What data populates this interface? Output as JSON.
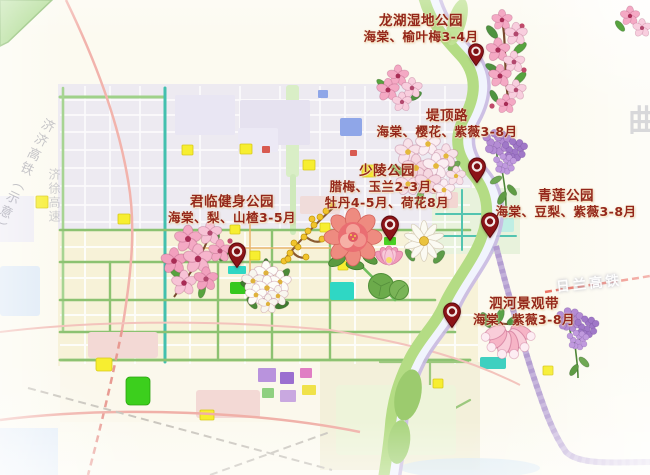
{
  "watermarks": {
    "railway_planned": "济济高铁（示意）",
    "expressway": "济徐高速",
    "railway_hsr": "日兰高铁",
    "partial_char": "曲"
  },
  "locations": [
    {
      "id": "longhu",
      "name": "龙湖湿地公园",
      "lines": [
        "海棠、榆叶梅3-4月"
      ]
    },
    {
      "id": "didinglu",
      "name": "堤顶路",
      "lines": [
        "海棠、樱花、紫薇3-8月"
      ]
    },
    {
      "id": "shaoling",
      "name": "少陵公园",
      "lines": [
        "腊梅、玉兰2-3月、",
        "牡丹4-5月、荷花8月"
      ]
    },
    {
      "id": "qinglian",
      "name": "青莲公园",
      "lines": [
        "海棠、豆梨、紫薇3-8月"
      ]
    },
    {
      "id": "junlin",
      "name": "君临健身公园",
      "lines": [
        "海棠、梨、山楂3-5月"
      ]
    },
    {
      "id": "sihe",
      "name": "泗河景观带",
      "lines": [
        "海棠、紫薇3-8月"
      ]
    }
  ],
  "colors": {
    "label_text": "#94271b",
    "pin": "#8c1417",
    "river_green": "#b4dc84",
    "river_lavender": "#c8b9e2",
    "purple_road": "#b9a3d6",
    "highlight_yellow": "#f7ee30"
  }
}
